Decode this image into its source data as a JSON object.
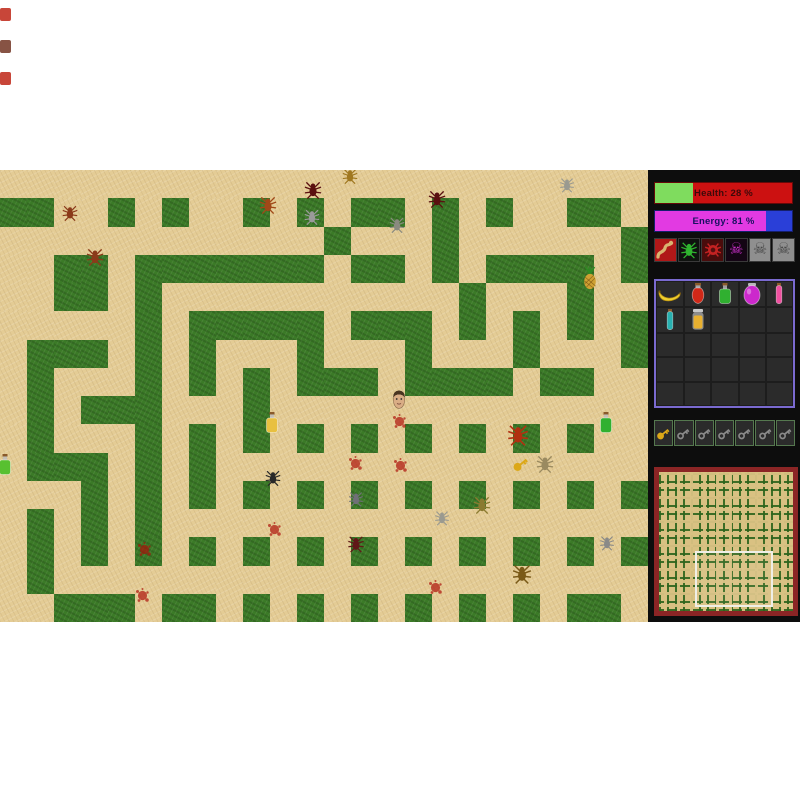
{
  "window": {
    "game_top": 170,
    "game_height": 452,
    "margin_marks": [
      {
        "color": "#c23224",
        "y": 8
      },
      {
        "color": "#7a4030",
        "y": 40
      },
      {
        "color": "#c23224",
        "y": 72
      }
    ]
  },
  "hud": {
    "health": {
      "label": "Health: 28 %",
      "percent": 28,
      "fill_color": "#7fdc5e",
      "bar_color": "#cc1111",
      "text_color": "#3c0a0a"
    },
    "energy": {
      "label": "Energy: 81 %",
      "percent": 81,
      "fill_color": "#e23ae2",
      "bar_color": "#2a3fd8",
      "text_color": "#181060"
    },
    "creatures": [
      {
        "name": "snake-icon",
        "bg": "#b01818",
        "color": "#d9b470",
        "alive": true
      },
      {
        "name": "green-spider-icon",
        "bg": "#0f120f",
        "color": "#2fb52f",
        "alive": true
      },
      {
        "name": "red-spider-icon",
        "bg": "#4a0c0c",
        "color": "#c42222",
        "alive": true
      },
      {
        "name": "purple-skull-icon",
        "bg": "#140514",
        "color": "#cc30cc",
        "alive": true
      },
      {
        "name": "gray-skull-icon",
        "bg": "#8f8f8f",
        "color": "#474747",
        "alive": false
      },
      {
        "name": "gray-skull-icon",
        "bg": "#8f8f8f",
        "color": "#474747",
        "alive": false
      }
    ],
    "inventory": {
      "rows": 5,
      "cols": 5,
      "border_color": "#7a6ad0",
      "items": [
        {
          "slot": 0,
          "kind": "banana",
          "color": "#f0d030"
        },
        {
          "slot": 1,
          "kind": "flask",
          "color": "#d02818"
        },
        {
          "slot": 2,
          "kind": "bottle",
          "color": "#30b030"
        },
        {
          "slot": 3,
          "kind": "jar",
          "color": "#cc28cc"
        },
        {
          "slot": 4,
          "kind": "vial",
          "color": "#f050a0"
        },
        {
          "slot": 5,
          "kind": "vial",
          "color": "#28b0b0"
        },
        {
          "slot": 6,
          "kind": "jar2",
          "color": "#e8b030"
        }
      ]
    },
    "keys": {
      "total": 7,
      "collected": 1,
      "gold_color": "#dca818",
      "empty_color": "#8a8a8a"
    },
    "minimap": {
      "border_color": "#8b2525",
      "viewport_rect": {
        "left_pct": 27,
        "top_pct": 57,
        "width_pct": 55,
        "height_pct": 37
      }
    }
  },
  "maze": {
    "cols": 24,
    "rows": 16,
    "wall_color": "#3b7a27",
    "path_color": "#e4cc95",
    "rows_map": [
      "........................",
      "##..#.#..#.#.##.#.#..##.",
      "............#...#......#",
      "..##.#######.##.#.####.#",
      "..##.#...........#...#..",
      ".....#.#####.###.#.#.#.#",
      ".###.#.#...#...#...#...#",
      ".#...#.#.#.###.####.##..",
      ".#.###...#..............",
      ".#...#.#.#.#.#.#.#.#.#..",
      ".###.#.#................",
      "...#.#.#.#.#.#.#.#.#.#.#",
      ".#.#.#..................",
      ".#.#.#.#.#.#.#.#.#.#.#.#",
      ".#......................",
      "..###.##.#.#.#.#.#.#.##."
    ]
  },
  "entities": {
    "player": {
      "x": 399,
      "y": 229
    },
    "spiders": [
      {
        "x": 70,
        "y": 43,
        "color": "#8b3a1a",
        "size": 17
      },
      {
        "x": 95,
        "y": 87,
        "color": "#8b3a1a",
        "size": 19
      },
      {
        "x": 268,
        "y": 35,
        "color": "#a04818",
        "size": 19
      },
      {
        "x": 313,
        "y": 20,
        "color": "#5a1010",
        "size": 19
      },
      {
        "x": 312,
        "y": 47,
        "color": "#9a9a9a",
        "size": 17
      },
      {
        "x": 350,
        "y": 6,
        "color": "#a07820",
        "size": 17
      },
      {
        "x": 437,
        "y": 29,
        "color": "#5a1010",
        "size": 19
      },
      {
        "x": 397,
        "y": 55,
        "color": "#8a8a80",
        "size": 17
      },
      {
        "x": 567,
        "y": 15,
        "color": "#9a9a90",
        "size": 16
      },
      {
        "x": 518,
        "y": 265,
        "color": "#b03010",
        "size": 23
      },
      {
        "x": 545,
        "y": 294,
        "color": "#9a8a60",
        "size": 19
      },
      {
        "x": 273,
        "y": 308,
        "color": "#282828",
        "size": 17
      },
      {
        "x": 356,
        "y": 329,
        "color": "#707078",
        "size": 16
      },
      {
        "x": 482,
        "y": 335,
        "color": "#8a7a30",
        "size": 19
      },
      {
        "x": 442,
        "y": 348,
        "color": "#9a9a90",
        "size": 16
      },
      {
        "x": 356,
        "y": 374,
        "color": "#601818",
        "size": 18
      },
      {
        "x": 607,
        "y": 373,
        "color": "#8a8a88",
        "size": 16
      },
      {
        "x": 522,
        "y": 404,
        "color": "#7a5a18",
        "size": 21
      }
    ],
    "items": [
      {
        "kind": "pineapple",
        "x": 590,
        "y": 108
      },
      {
        "kind": "bottle-yellow",
        "x": 272,
        "y": 253,
        "color": "#e8c040"
      },
      {
        "kind": "bottle-green",
        "x": 606,
        "y": 253,
        "color": "#30b030"
      },
      {
        "kind": "bottle-green",
        "x": 5,
        "y": 295,
        "color": "#58c030"
      },
      {
        "kind": "key-gold",
        "x": 521,
        "y": 294,
        "color": "#dca818"
      }
    ],
    "blood": [
      {
        "x": 400,
        "y": 252
      },
      {
        "x": 356,
        "y": 294
      },
      {
        "x": 401,
        "y": 296
      },
      {
        "x": 275,
        "y": 360
      },
      {
        "x": 145,
        "y": 380
      },
      {
        "x": 143,
        "y": 426
      },
      {
        "x": 436,
        "y": 418
      }
    ]
  }
}
